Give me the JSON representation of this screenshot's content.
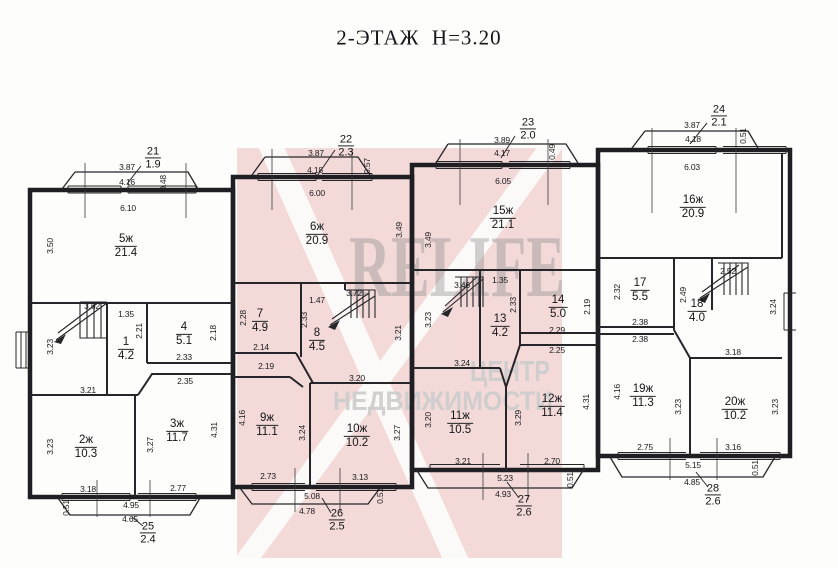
{
  "title": "2-ЭТАЖ  Н=3.20",
  "watermark": {
    "brand": "RELIFE",
    "line1": "ЦЕНТР",
    "line2": "НЕДВИЖИМОСТИ",
    "pink": "#e5a9a9",
    "text_grey": "#8a8a8a"
  },
  "rooms": [
    {
      "num": "5ж",
      "area": "21.4",
      "x": 126,
      "y": 246
    },
    {
      "num": "1",
      "area": "4.2",
      "x": 126,
      "y": 349
    },
    {
      "num": "4",
      "area": "5.1",
      "x": 184,
      "y": 334
    },
    {
      "num": "2ж",
      "area": "10.3",
      "x": 86,
      "y": 447
    },
    {
      "num": "3ж",
      "area": "11.7",
      "x": 177,
      "y": 431
    },
    {
      "num": "6ж",
      "area": "20.9",
      "x": 317,
      "y": 234
    },
    {
      "num": "7",
      "area": "4.9",
      "x": 260,
      "y": 321
    },
    {
      "num": "8",
      "area": "4.5",
      "x": 317,
      "y": 340
    },
    {
      "num": "9ж",
      "area": "11.1",
      "x": 267,
      "y": 425
    },
    {
      "num": "10ж",
      "area": "10.2",
      "x": 357,
      "y": 436
    },
    {
      "num": "15ж",
      "area": "21.1",
      "x": 503,
      "y": 218
    },
    {
      "num": "13",
      "area": "4.2",
      "x": 500,
      "y": 326
    },
    {
      "num": "14",
      "area": "5.0",
      "x": 558,
      "y": 307
    },
    {
      "num": "11ж",
      "area": "10.5",
      "x": 460,
      "y": 423
    },
    {
      "num": "12ж",
      "area": "11.4",
      "x": 552,
      "y": 406
    },
    {
      "num": "16ж",
      "area": "20.9",
      "x": 693,
      "y": 207
    },
    {
      "num": "17",
      "area": "5.5",
      "x": 640,
      "y": 290
    },
    {
      "num": "18",
      "area": "4.0",
      "x": 697,
      "y": 311
    },
    {
      "num": "19ж",
      "area": "11.3",
      "x": 643,
      "y": 396
    },
    {
      "num": "20ж",
      "area": "10.2",
      "x": 735,
      "y": 409
    }
  ],
  "balconies": [
    {
      "num": "21",
      "area": "1.9",
      "x": 153,
      "y": 158
    },
    {
      "num": "22",
      "area": "2.3",
      "x": 346,
      "y": 146
    },
    {
      "num": "23",
      "area": "2.0",
      "x": 528,
      "y": 129
    },
    {
      "num": "24",
      "area": "2.1",
      "x": 719,
      "y": 116
    },
    {
      "num": "25",
      "area": "2.4",
      "x": 148,
      "y": 533
    },
    {
      "num": "26",
      "area": "2.5",
      "x": 337,
      "y": 520
    },
    {
      "num": "27",
      "area": "2.6",
      "x": 524,
      "y": 506
    },
    {
      "num": "28",
      "area": "2.6",
      "x": 713,
      "y": 495
    }
  ],
  "dims": [
    {
      "t": "3.87",
      "x": 127,
      "y": 167
    },
    {
      "t": "4.16",
      "x": 127,
      "y": 182
    },
    {
      "t": "0.48",
      "x": 163,
      "y": 183,
      "r": -90
    },
    {
      "t": "6.10",
      "x": 128,
      "y": 208
    },
    {
      "t": "3.50",
      "x": 50,
      "y": 246,
      "r": -90
    },
    {
      "t": "3.62",
      "x": 92,
      "y": 306
    },
    {
      "t": "1.35",
      "x": 126,
      "y": 314
    },
    {
      "t": "2.21",
      "x": 139,
      "y": 331,
      "r": -90
    },
    {
      "t": "3.23",
      "x": 50,
      "y": 347,
      "r": -90
    },
    {
      "t": "2.18",
      "x": 213,
      "y": 333,
      "r": -90
    },
    {
      "t": "2.33",
      "x": 184,
      "y": 357
    },
    {
      "t": "2.35",
      "x": 185,
      "y": 381
    },
    {
      "t": "3.21",
      "x": 88,
      "y": 390
    },
    {
      "t": "3.23",
      "x": 50,
      "y": 447,
      "r": -90
    },
    {
      "t": "3.27",
      "x": 150,
      "y": 445,
      "r": -90
    },
    {
      "t": "4.31",
      "x": 214,
      "y": 430,
      "r": -90
    },
    {
      "t": "3.18",
      "x": 88,
      "y": 489
    },
    {
      "t": "2.77",
      "x": 178,
      "y": 488
    },
    {
      "t": "4.95",
      "x": 131,
      "y": 505
    },
    {
      "t": "0.51",
      "x": 66,
      "y": 508,
      "r": -90
    },
    {
      "t": "4.65",
      "x": 130,
      "y": 519
    },
    {
      "t": "3.87",
      "x": 316,
      "y": 153
    },
    {
      "t": "4.18",
      "x": 315,
      "y": 170
    },
    {
      "t": "0.57",
      "x": 367,
      "y": 166,
      "r": -90
    },
    {
      "t": "6.00",
      "x": 317,
      "y": 193
    },
    {
      "t": "3.49",
      "x": 399,
      "y": 230,
      "r": -90
    },
    {
      "t": "2.28",
      "x": 243,
      "y": 318,
      "r": -90
    },
    {
      "t": "2.14",
      "x": 261,
      "y": 347
    },
    {
      "t": "2.19",
      "x": 266,
      "y": 366
    },
    {
      "t": "1.47",
      "x": 317,
      "y": 300
    },
    {
      "t": "2.33",
      "x": 304,
      "y": 320,
      "r": -90
    },
    {
      "t": "3.72",
      "x": 354,
      "y": 293
    },
    {
      "t": "3.21",
      "x": 398,
      "y": 333,
      "r": -90
    },
    {
      "t": "3.20",
      "x": 357,
      "y": 378
    },
    {
      "t": "4.16",
      "x": 242,
      "y": 418,
      "r": -90
    },
    {
      "t": "3.24",
      "x": 302,
      "y": 433,
      "r": -90
    },
    {
      "t": "2.73",
      "x": 268,
      "y": 476
    },
    {
      "t": "3.27",
      "x": 397,
      "y": 433,
      "r": -90
    },
    {
      "t": "3.13",
      "x": 360,
      "y": 477
    },
    {
      "t": "5.08",
      "x": 312,
      "y": 496
    },
    {
      "t": "0.51",
      "x": 380,
      "y": 496,
      "r": -90
    },
    {
      "t": "4.78",
      "x": 307,
      "y": 511
    },
    {
      "t": "3.89",
      "x": 502,
      "y": 140
    },
    {
      "t": "4.17",
      "x": 502,
      "y": 153
    },
    {
      "t": "0.49",
      "x": 552,
      "y": 152,
      "r": -90
    },
    {
      "t": "6.05",
      "x": 503,
      "y": 181
    },
    {
      "t": "3.49",
      "x": 428,
      "y": 240,
      "r": -90
    },
    {
      "t": "1.35",
      "x": 500,
      "y": 280
    },
    {
      "t": "3.46",
      "x": 462,
      "y": 285
    },
    {
      "t": "2.33",
      "x": 513,
      "y": 305,
      "r": -90
    },
    {
      "t": "3.23",
      "x": 428,
      "y": 320,
      "r": -90
    },
    {
      "t": "2.19",
      "x": 587,
      "y": 307,
      "r": -90
    },
    {
      "t": "2.29",
      "x": 557,
      "y": 330
    },
    {
      "t": "2.25",
      "x": 557,
      "y": 350
    },
    {
      "t": "3.24",
      "x": 462,
      "y": 363
    },
    {
      "t": "3.20",
      "x": 428,
      "y": 420,
      "r": -90
    },
    {
      "t": "3.29",
      "x": 518,
      "y": 418,
      "r": -90
    },
    {
      "t": "3.21",
      "x": 463,
      "y": 461
    },
    {
      "t": "4.31",
      "x": 586,
      "y": 402,
      "r": -90
    },
    {
      "t": "2.70",
      "x": 552,
      "y": 461
    },
    {
      "t": "5.23",
      "x": 505,
      "y": 478
    },
    {
      "t": "0.51",
      "x": 570,
      "y": 480,
      "r": -90
    },
    {
      "t": "4.93",
      "x": 503,
      "y": 494
    },
    {
      "t": "3.87",
      "x": 692,
      "y": 125
    },
    {
      "t": "4.18",
      "x": 693,
      "y": 139
    },
    {
      "t": "0.51",
      "x": 743,
      "y": 136,
      "r": -90
    },
    {
      "t": "6.03",
      "x": 692,
      "y": 167
    },
    {
      "t": "2.32",
      "x": 617,
      "y": 292,
      "r": -90
    },
    {
      "t": "2.38",
      "x": 640,
      "y": 322
    },
    {
      "t": "2.38",
      "x": 640,
      "y": 339
    },
    {
      "t": "2.49",
      "x": 683,
      "y": 295,
      "r": -90
    },
    {
      "t": "2.52",
      "x": 728,
      "y": 271
    },
    {
      "t": "3.18",
      "x": 733,
      "y": 352
    },
    {
      "t": "3.24",
      "x": 773,
      "y": 307,
      "r": -90
    },
    {
      "t": "4.16",
      "x": 617,
      "y": 392,
      "r": -90
    },
    {
      "t": "3.23",
      "x": 678,
      "y": 407,
      "r": -90
    },
    {
      "t": "2.75",
      "x": 645,
      "y": 447
    },
    {
      "t": "3.23",
      "x": 775,
      "y": 407,
      "r": -90
    },
    {
      "t": "3.16",
      "x": 733,
      "y": 447
    },
    {
      "t": "5.15",
      "x": 693,
      "y": 465
    },
    {
      "t": "0.51",
      "x": 755,
      "y": 468,
      "r": -90
    },
    {
      "t": "4.85",
      "x": 692,
      "y": 482
    }
  ]
}
